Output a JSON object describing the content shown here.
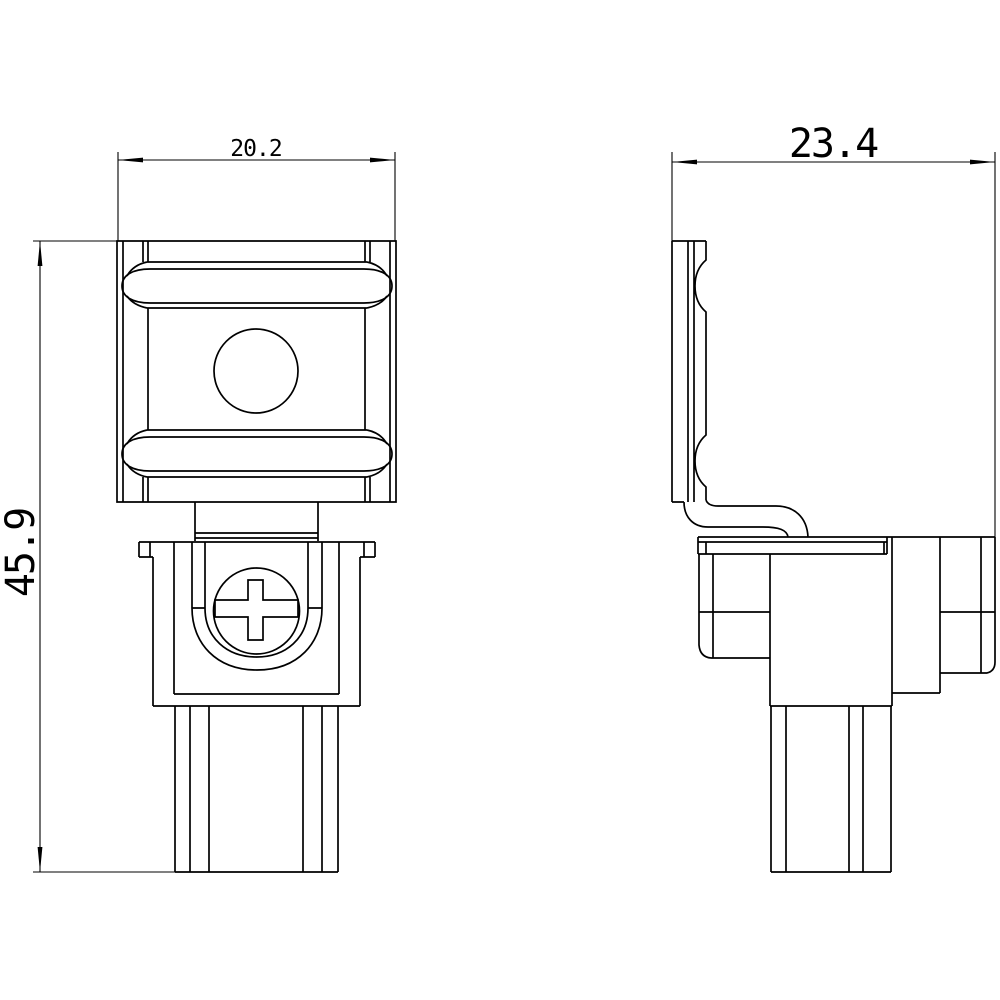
{
  "colors": {
    "background": "#ffffff",
    "line": "#000000"
  },
  "views": {
    "front": {
      "width_dim": "20.2",
      "height_dim": "45.9"
    },
    "side": {
      "width_dim": "23.4"
    }
  }
}
